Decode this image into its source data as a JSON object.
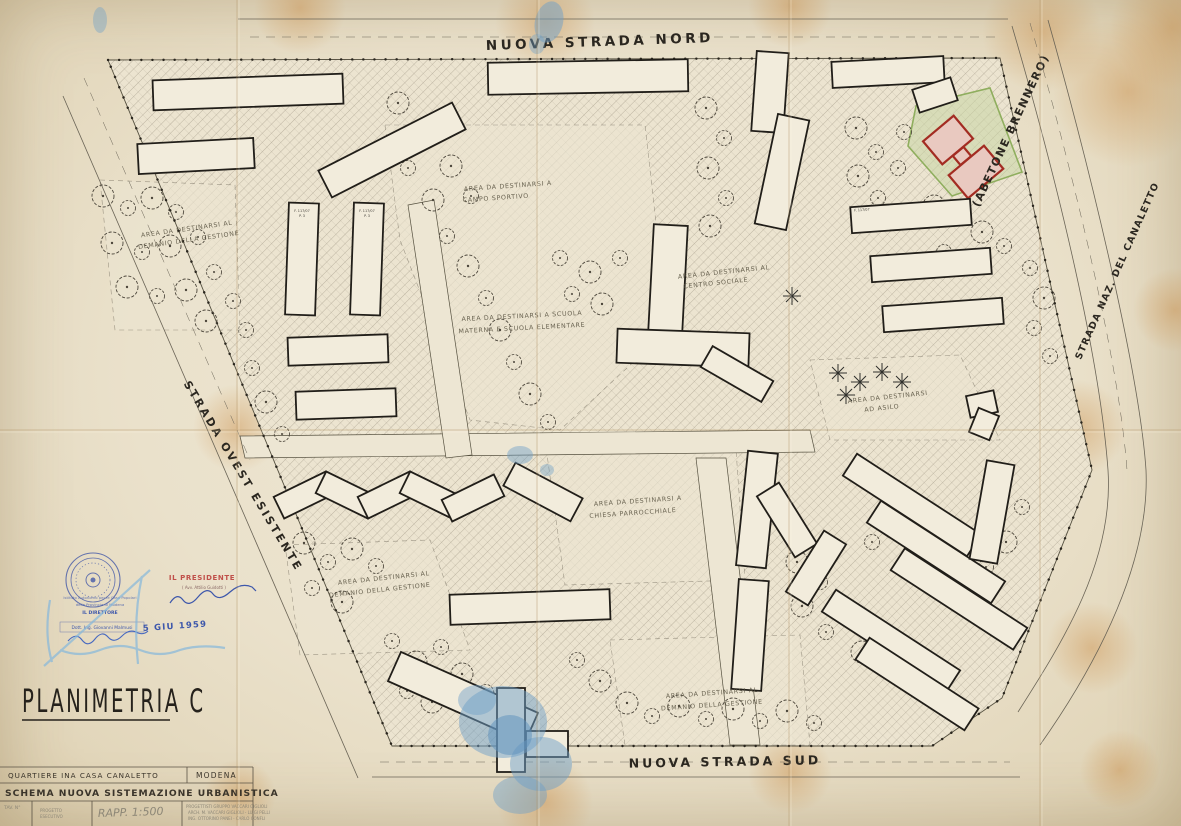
{
  "plan": {
    "title": "PLANIMETRIA C",
    "roads": {
      "north": "NUOVA STRADA NORD",
      "south": "NUOVA STRADA SUD",
      "west": "STRADA OVEST ESISTENTE",
      "east_upper": "(ABETONE BRENNERO)",
      "east_lower": "STRADA NAZ. DEL CANALETTO"
    },
    "areas": {
      "demanio_nw": {
        "line1": "AREA DA DESTINARSI AL",
        "line2": "DEMANIO DELLA GESTIONE"
      },
      "campo_sportivo": {
        "line1": "AREA DA DESTINARSI A",
        "line2": "CAMPO SPORTIVO"
      },
      "scuola": {
        "line1": "AREA DA DESTINARSI A SCUOLA",
        "line2": "MATERNA E SCUOLA ELEMENTARE"
      },
      "centro_sociale": {
        "line1": "AREA DA DESTINARSI AL",
        "line2": "CENTRO SOCIALE"
      },
      "asilo": {
        "line1": "AREA DA DESTINARSI",
        "line2": "AD ASILO"
      },
      "chiesa": {
        "line1": "AREA DA DESTINARSI A",
        "line2": "CHIESA PARROCCHIALE"
      },
      "demanio_sw": {
        "line1": "AREA DA DESTINARSI AL",
        "line2": "DEMANIO DELLA GESTIONE"
      },
      "demanio_se": {
        "line1": "AREA DA DESTINARSI AL",
        "line2": "DEMANIO DELLA GESTIONE"
      }
    },
    "building_labels": {
      "code": "F. 117/07",
      "floors": "P. 3"
    }
  },
  "title_block": {
    "row1_left": "QUARTIERE INA CASA CANALETTO",
    "row1_right": "MODENA",
    "row2": "SCHEMA NUOVA SISTEMAZIONE URBANISTICA",
    "tav_label": "TAV. N°",
    "scale": "RAPP. 1:500",
    "note1": "PROGETTO",
    "note2": "ESECUTIVO",
    "designers1": "PROGETTISTI GRUPPO VACCARI GIGLIOLI",
    "designers2": "ARCH. M. VACCARI GIGLIOLI - LUIGI PELLI",
    "designers3": "ING. OTTORINO PANEI - CARLO CONFLI"
  },
  "stamps": {
    "president_title": "IL PRESIDENTE",
    "president_name": "( Avv. Attilio Guidotti )",
    "office_line1": "Istituto Autonomo per le Case Popolari",
    "office_line2": "della Provincia di Modena",
    "director_title": "IL DIRETTORE",
    "director_name": "Dott. Ing. Giovanni Malmusi",
    "date": "5 GIU 1959"
  },
  "colors": {
    "paper": "#eae1cb",
    "ink": "#211e19",
    "red_building": "#a32c22",
    "green_parcel": "#8fae5e",
    "stamp_blue": "#3d57ab",
    "stamp_red": "#c0504a",
    "pencil_blue": "#85b8dc",
    "fold_stain": "#c8883f"
  }
}
